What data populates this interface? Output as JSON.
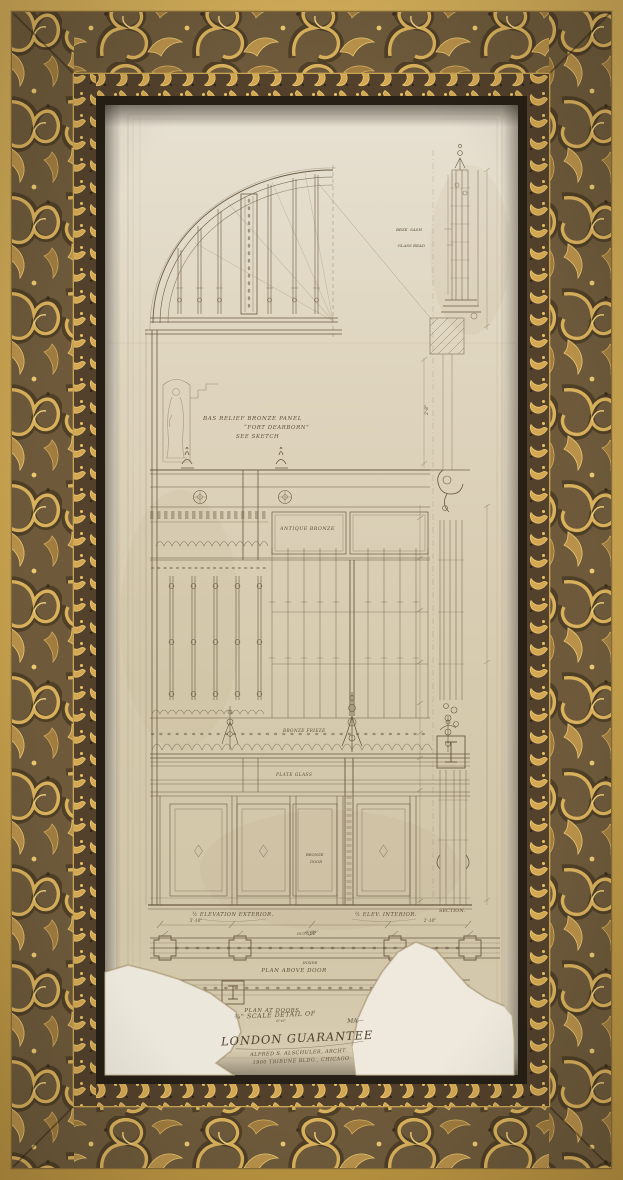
{
  "colors": {
    "outer_band_gold": "#c8a24e",
    "carved_band_base": "#6e5a3b",
    "carved_highlight": "#d9b15c",
    "bead_band_base": "#53412b",
    "frame_lip": "#262016",
    "paper": "#d9cfb5",
    "paper_patch": "#ece7db",
    "ink": "#6a5a42"
  },
  "annotations": {
    "bas_relief_line1": "BAS RELIEF BRONZE PANEL",
    "bas_relief_line2": "“FORT DEARBORN”",
    "bas_relief_line3": "SEE SKETCH",
    "antique_bronze": "ANTIQUE BRONZE",
    "bronze_frieze": "BRONZE FRIEZE",
    "plate_glass": "PLATE GLASS",
    "brze_sash": "BRZE. SASH",
    "glass_bead": "GLASS BEAD",
    "door_label_line1": "BRONZE",
    "door_label_line2": "DOOR",
    "elev_exterior": "½ ELEVATION EXTERIOR.",
    "elev_interior": "½ ELEV. INTERIOR.",
    "section": "SECTION.",
    "outside": "OUTSIDE",
    "inside": "INSIDE",
    "plan_above_door": "PLAN ABOVE DOOR",
    "plan_at_doors": "PLAN AT DOORS"
  },
  "dimensions": {
    "dim_left": "5'-10\"",
    "dim_center": "6'-6¼\"",
    "dim_right": "2'-10\"",
    "dim_vertical": "2'-8\"",
    "dim_plan": "6'-6\""
  },
  "title_block": {
    "line1": "¾\" SCALE DETAIL OF",
    "line2": "MA—",
    "line3": "LONDON GUARANTEE",
    "line4": "ALFRED S. ALSCHULER, ARCHT.",
    "line5": "1900 TRIBUNE BLDG., CHICAGO"
  }
}
